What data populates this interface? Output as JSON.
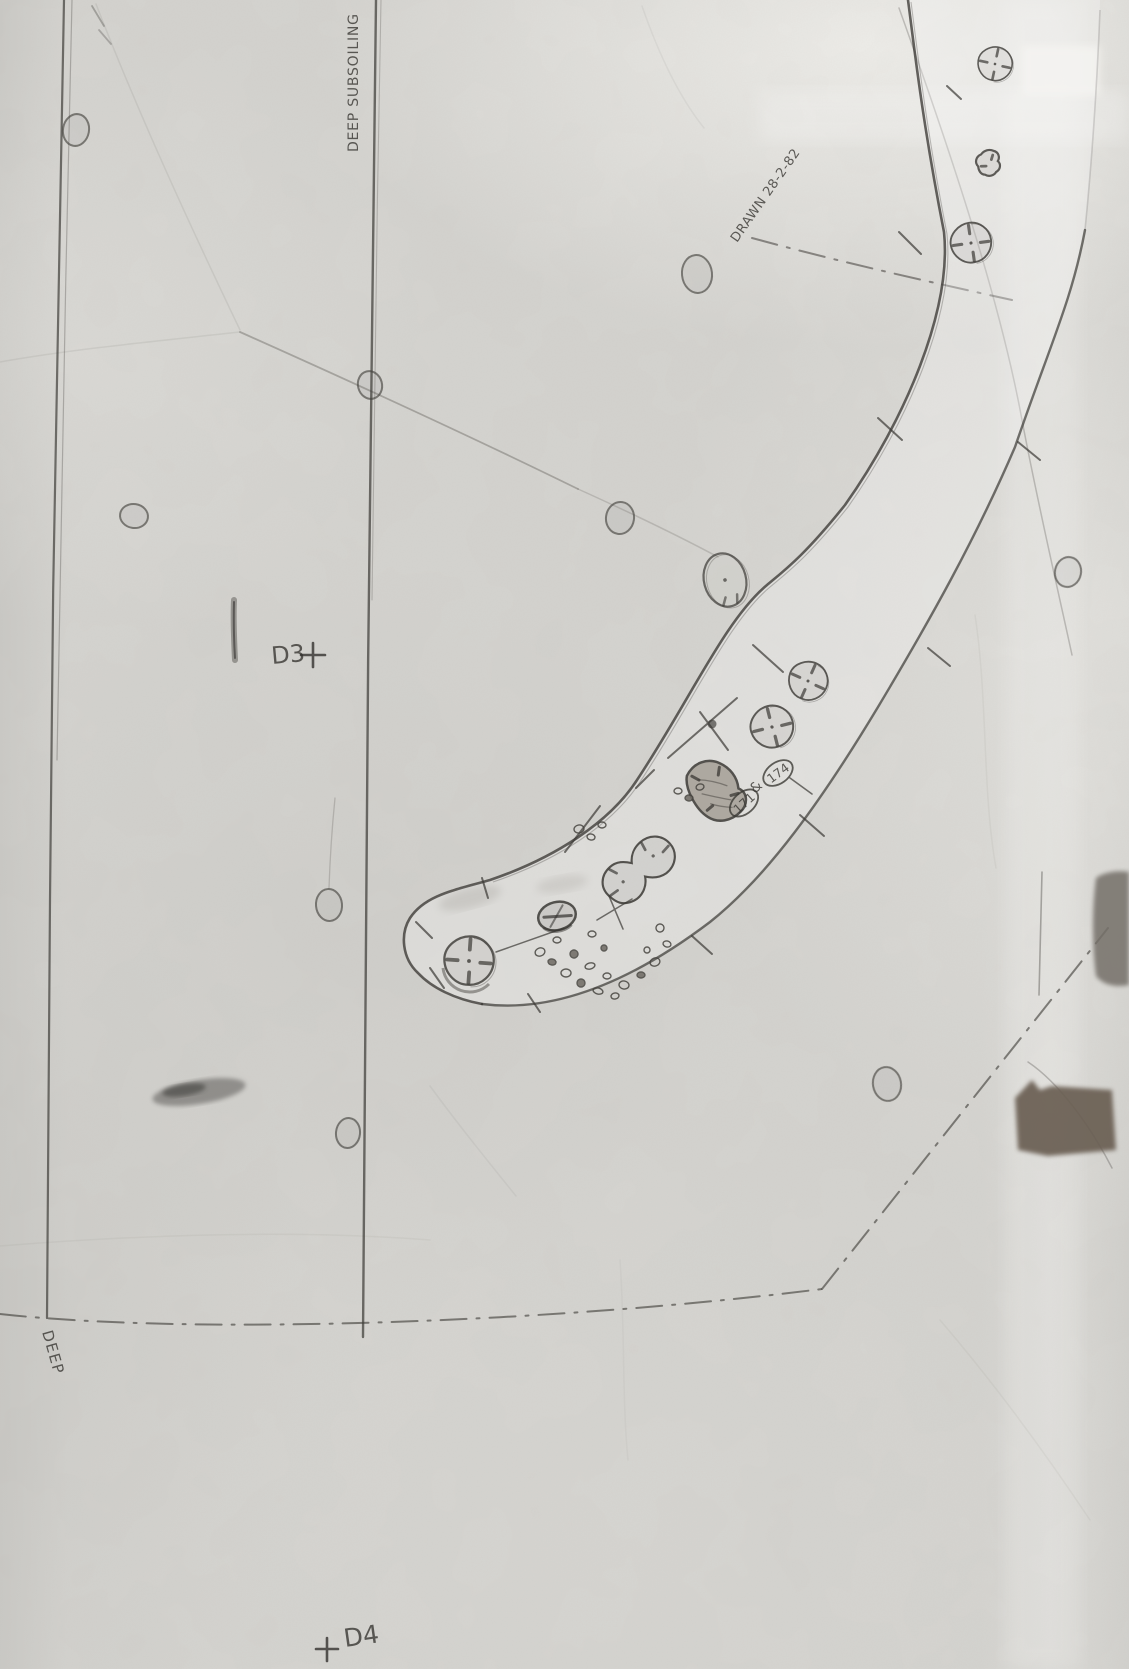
{
  "document": {
    "kind": "scanned hand-drawn excavation site plan, pencil on tracing paper"
  },
  "labels": {
    "subsoiling": "DEEP SUBSOILING",
    "deep": "DEEP",
    "drawn": "DRAWN 28-2-82",
    "d3": "D3",
    "d4": "D4"
  },
  "features": {
    "id_171": "171",
    "joiner": "&",
    "id_174": "174"
  },
  "colors": {
    "paper": "#d5d4d0",
    "pencil": "#44423e",
    "grey_patch": "#757069",
    "brown_patch": "#6a5f53"
  }
}
